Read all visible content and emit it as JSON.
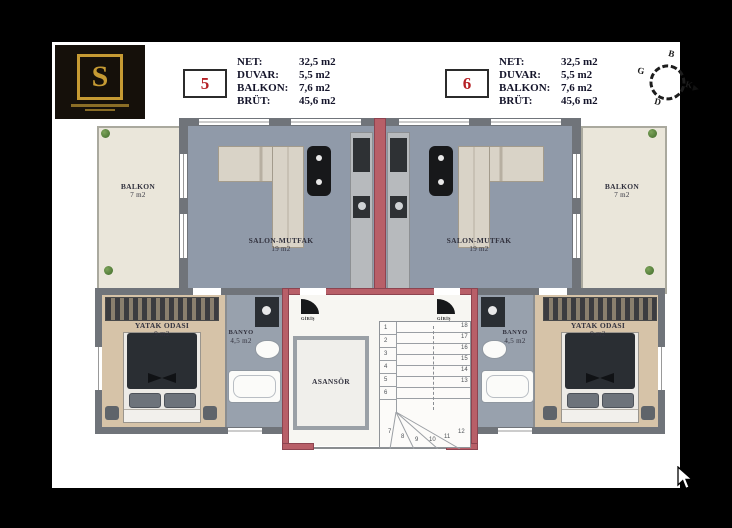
{
  "window": {
    "bg": "#000000",
    "panel_bg": "#ffffff"
  },
  "logo": {
    "monogram": "S"
  },
  "units": [
    {
      "number": "5",
      "rows": [
        {
          "label": "NET:",
          "value": "32,5 m2"
        },
        {
          "label": "DUVAR:",
          "value": "5,5 m2"
        },
        {
          "label": "BALKON:",
          "value": "7,6 m2"
        },
        {
          "label": "BRÜT:",
          "value": "45,6 m2"
        }
      ]
    },
    {
      "number": "6",
      "rows": [
        {
          "label": "NET:",
          "value": "32,5 m2"
        },
        {
          "label": "DUVAR:",
          "value": "5,5 m2"
        },
        {
          "label": "BALKON:",
          "value": "7,6 m2"
        },
        {
          "label": "BRÜT:",
          "value": "45,6 m2"
        }
      ]
    }
  ],
  "compass": {
    "top": "B",
    "right": "K",
    "bottom": "D",
    "left": "G"
  },
  "rooms": {
    "balkon": {
      "name": "BALKON",
      "area": "7 m2"
    },
    "salon": {
      "name": "SALON-MUTFAK",
      "area": "19 m2"
    },
    "yatak": {
      "name": "YATAK ODASI",
      "area": "9 m2"
    },
    "banyo": {
      "name": "BANYO",
      "area": "4,5 m2"
    },
    "asansor": {
      "name": "ASANSÖR"
    },
    "giris": {
      "name": "GİRİŞ"
    }
  },
  "stairs": {
    "left_column": [
      "1",
      "2",
      "3",
      "4",
      "5",
      "6"
    ],
    "bottom_row": [
      "7",
      "8",
      "9",
      "10",
      "11",
      "12"
    ],
    "right_column": [
      "18",
      "17",
      "16",
      "15",
      "14",
      "13"
    ]
  },
  "colors": {
    "wall_red": "#b85f68",
    "wall_gray": "#70747a",
    "floor_salon": "#909aa9",
    "floor_balcony": "#eae6da",
    "floor_bedroom": "#d6c3a8",
    "floor_bath": "#98a1ad",
    "accent_gold": "#c59a33",
    "unit_number_red": "#b52025"
  }
}
